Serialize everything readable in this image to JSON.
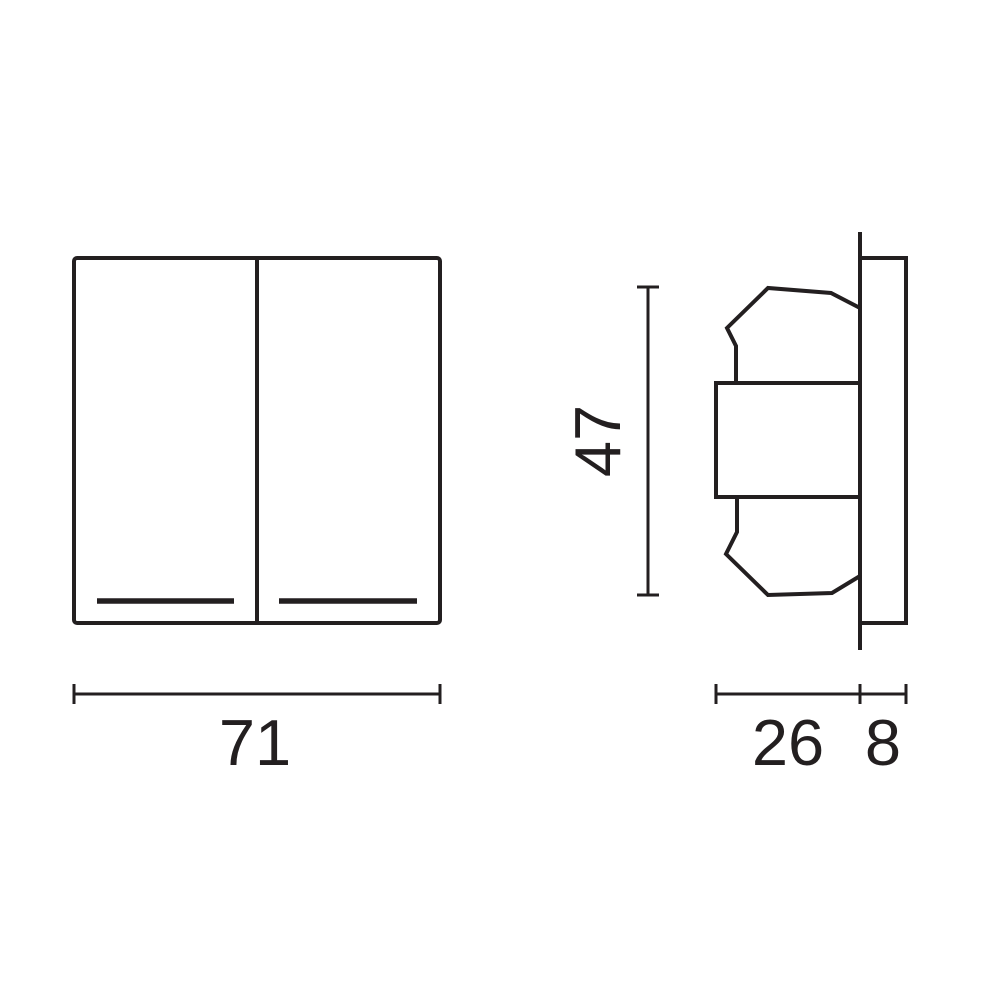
{
  "diagram": {
    "type": "technical-dimension-drawing",
    "subject": "double-rocker-wall-switch",
    "line_color": "#231f20",
    "background_color": "#ffffff",
    "views": {
      "front": {
        "width_dimension": {
          "label": "71",
          "value": 71
        }
      },
      "side": {
        "height_dimension": {
          "label": "47",
          "value": 47
        },
        "depth_dimension": {
          "label": "26",
          "value": 26
        },
        "plate_thickness_dimension": {
          "label": "8",
          "value": 8
        }
      }
    }
  }
}
